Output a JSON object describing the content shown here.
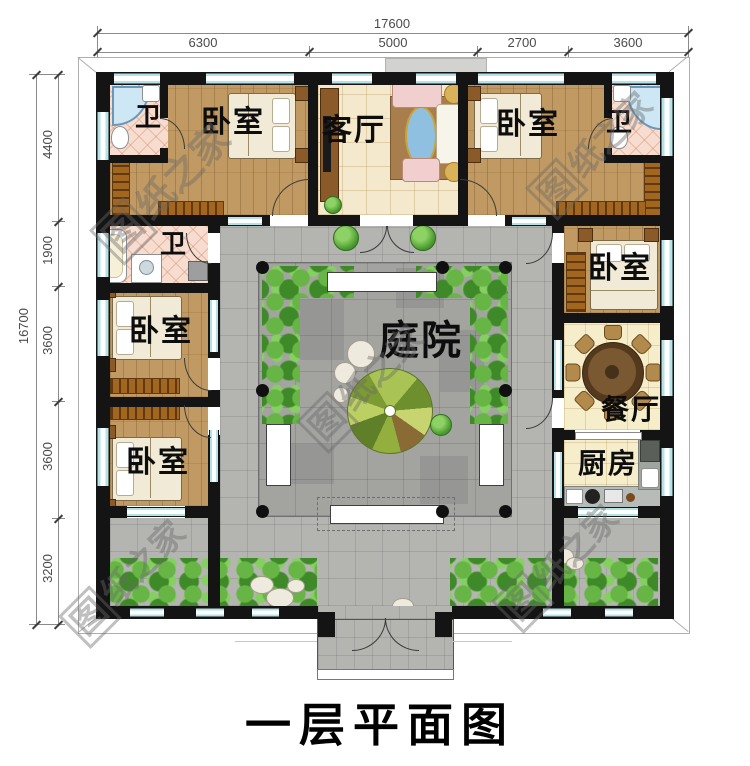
{
  "page_title": "一层平面图",
  "watermark": {
    "box_char": "图",
    "rest": "纸之家"
  },
  "dims": {
    "top": {
      "total": "17600",
      "segs": [
        "6300",
        "5000",
        "2700",
        "3600"
      ]
    },
    "left": {
      "total": "16700",
      "segs": [
        "4400",
        "1900",
        "3600",
        "3600",
        "3200"
      ]
    }
  },
  "rooms": {
    "bath_top_left": "卫",
    "bed_top_left": "卧室",
    "living": "客厅",
    "bed_top_right": "卧室",
    "bath_top_right": "卫",
    "bath_left": "卫",
    "bed_mid_left": "卧室",
    "bed_low_left": "卧室",
    "bed_right": "卧室",
    "dining": "餐厅",
    "kitchen": "厨房",
    "courtyard": "庭院"
  },
  "colors": {
    "wall": "#141414",
    "window_glass": "#b5e2e6",
    "wood_floor": "#c09a62",
    "living_floor": "#f4e9cd",
    "bath_tile": "#f7ddd0",
    "dining_floor": "#f6eecb",
    "walkway_paving": "#b4b4b1",
    "courtyard_paving": "#a3a3a0",
    "greenery": "#4e9c33",
    "watermark": "#696969"
  }
}
